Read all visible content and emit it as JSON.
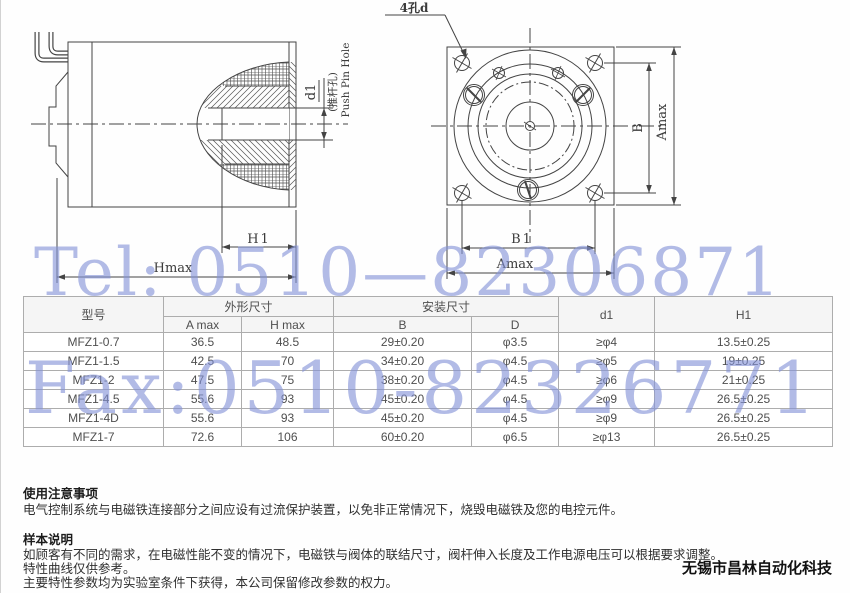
{
  "watermark": {
    "tel": "Tel: 0510—82306871",
    "fax": "Fax:0510-82326771",
    "color": "#8291d7"
  },
  "drawings": {
    "side_view": {
      "d1_label": "d1",
      "pin_hole_cn": "(推杆孔)",
      "pin_hole_en": "Push Pin Hole",
      "h1_label": "H1",
      "hmax_label": "Hmax"
    },
    "front_view": {
      "holes_label": "4孔d",
      "b_label": "B",
      "amax_vertical_label": "Amax",
      "b1_label": "B1",
      "amax_horizontal_label": "Amax"
    }
  },
  "table": {
    "headers": {
      "model": "型号",
      "outline_dims": "外形尺寸",
      "a_max": "A max",
      "h_max": "H max",
      "mount_dims": "安装尺寸",
      "b": "B",
      "d": "D",
      "d1": "d1",
      "h1": "H1"
    },
    "rows": [
      [
        "MFZ1-0.7",
        "36.5",
        "48.5",
        "29±0.20",
        "φ3.5",
        "≥φ4",
        "13.5±0.25"
      ],
      [
        "MFZ1-1.5",
        "42.5",
        "70",
        "34±0.20",
        "φ4.5",
        "≥φ5",
        "19±0.25"
      ],
      [
        "MFZ1-2",
        "47.5",
        "75",
        "38±0.20",
        "φ4.5",
        "≥φ6",
        "21±0.25"
      ],
      [
        "MFZ1-4.5",
        "55.6",
        "93",
        "45±0.20",
        "φ4.5",
        "≥φ9",
        "26.5±0.25"
      ],
      [
        "MFZ1-4D",
        "55.6",
        "93",
        "45±0.20",
        "φ4.5",
        "≥φ9",
        "26.5±0.25"
      ],
      [
        "MFZ1-7",
        "72.6",
        "106",
        "60±0.20",
        "φ6.5",
        "≥φ13",
        "26.5±0.25"
      ]
    ]
  },
  "notes": {
    "usage_title": "使用注意事项",
    "usage_body": "电气控制系统与电磁铁连接部分之间应设有过流保护装置，以免非正常情况下，烧毁电磁铁及您的电控元件。",
    "sample_title": "样本说明",
    "sample_line1": "如顾客有不同的需求，在电磁性能不变的情况下，电磁铁与阀体的联结尺寸，阀杆伸入长度及工作电源电压可以根据要求调整。",
    "sample_line2": "特性曲线仅供参考。",
    "sample_line3": "主要特性参数均为实验室条件下获得，本公司保留修改参数的权力。",
    "company": "无锡市昌林自动化科技"
  }
}
